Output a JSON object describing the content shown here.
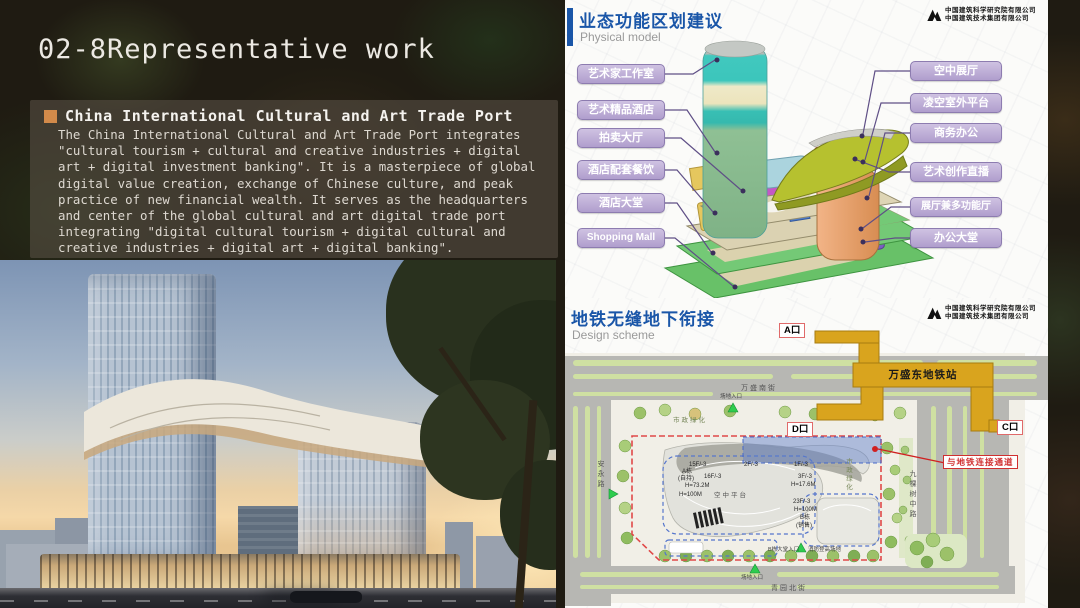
{
  "slide_title": "02-8Representative work",
  "intro": {
    "heading": "China International Cultural and Art Trade Port",
    "body": "The China International Cultural and Art Trade Port integrates \"cultural tourism + cultural and creative industries + digital art + digital investment banking\". It is a masterpiece of global digital value creation, exchange of Chinese culture, and peak practice of new financial wealth. It serves as the headquarters and center of the global cultural and art digital trade port integrating \"digital cultural tourism + digital cultural and creative industries + digital art + digital banking\"."
  },
  "logo": {
    "line1": "中国建筑科学研究院有限公司",
    "line2": "中国建筑技术集团有限公司"
  },
  "model_panel": {
    "title": "业态功能区划建议",
    "subtitle": "Physical model",
    "left_labels": [
      "艺术家工作室",
      "艺术精品酒店",
      "拍卖大厅",
      "酒店配套餐饮",
      "酒店大堂",
      "Shopping Mall"
    ],
    "right_labels": [
      "空中展厅",
      "凌空室外平台",
      "商务办公",
      "艺术创作直播",
      "展厅兼多功能厅",
      "办公大堂"
    ]
  },
  "plan_panel": {
    "title": "地铁无缝地下衔接",
    "subtitle": "Design scheme",
    "station": "万盛东地铁站",
    "exit_a": "A口",
    "exit_c": "C口",
    "exit_d": "D口",
    "connection": "与地铁连接通道",
    "roads": {
      "north": "万盛南街",
      "south": "青园北街",
      "west": "安永路",
      "east": "九棵树中路"
    },
    "greening": "市政绿化",
    "tower_a": {
      "floors_wing": "15F/-3",
      "name": "A栋",
      "tenure": "(自持)",
      "floors": "16F/-3",
      "height": "H=73.2M",
      "height_max": "H=100M"
    },
    "platform": "空中平台",
    "podium": {
      "p2f": "2F/-3",
      "p1f": "1F/-3",
      "p3f": "3F/-3",
      "p3f_h": "H=17.6M"
    },
    "tower_b": {
      "floors": "23F/-3",
      "height": "H=100M",
      "name": "B栋",
      "tenure": "(销售)"
    },
    "markers": {
      "entrance_top": "场地入口",
      "entrance_bottom": "场地入口",
      "entrance_b": "B栋大堂入口",
      "fire_ground": "消防登高场地"
    }
  },
  "colors": {
    "accent_blue": "#1a56a8",
    "label_purple": "#b3a2cc",
    "metro_gold": "#d9a41e",
    "alert_red": "#d03030",
    "bullet_orange": "#d28a4a"
  }
}
